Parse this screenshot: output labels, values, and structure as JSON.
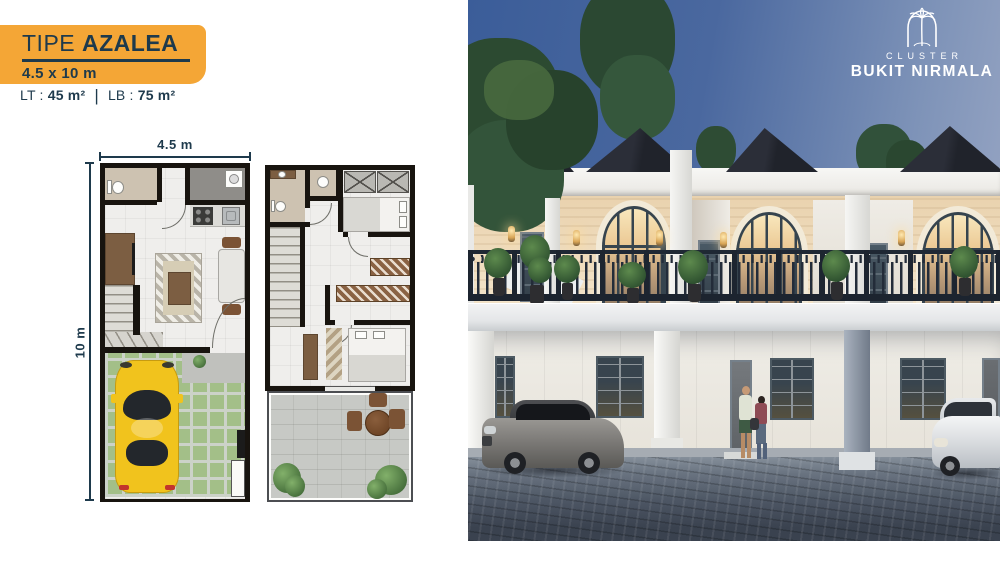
{
  "header": {
    "type_label": "TIPE",
    "type_name": "AZALEA",
    "size_text": "4.5 x 10 m",
    "lt_label": "LT :",
    "lt_value": "45 m²",
    "separator": "|",
    "lb_label": "LB :",
    "lb_value": "75 m²"
  },
  "floorplan": {
    "width_dim_label": "4.5 m",
    "height_dim_label": "10 m"
  },
  "brand": {
    "cluster_label": "CLUSTER",
    "name": "BUKIT NIRMALA",
    "logo_icon": "palm-tree-arch-icon"
  },
  "colors": {
    "accent_orange": "#F4A636",
    "navy": "#1E3A4C",
    "plan_wall": "#18140F",
    "car_yellow": "#F1C31D",
    "sky_top": "#3B5D99",
    "roof_dark": "#20232B",
    "facade_cream": "#E9D2AE",
    "railing_dark": "#1F2834",
    "pavement_dark": "#3A424F"
  }
}
